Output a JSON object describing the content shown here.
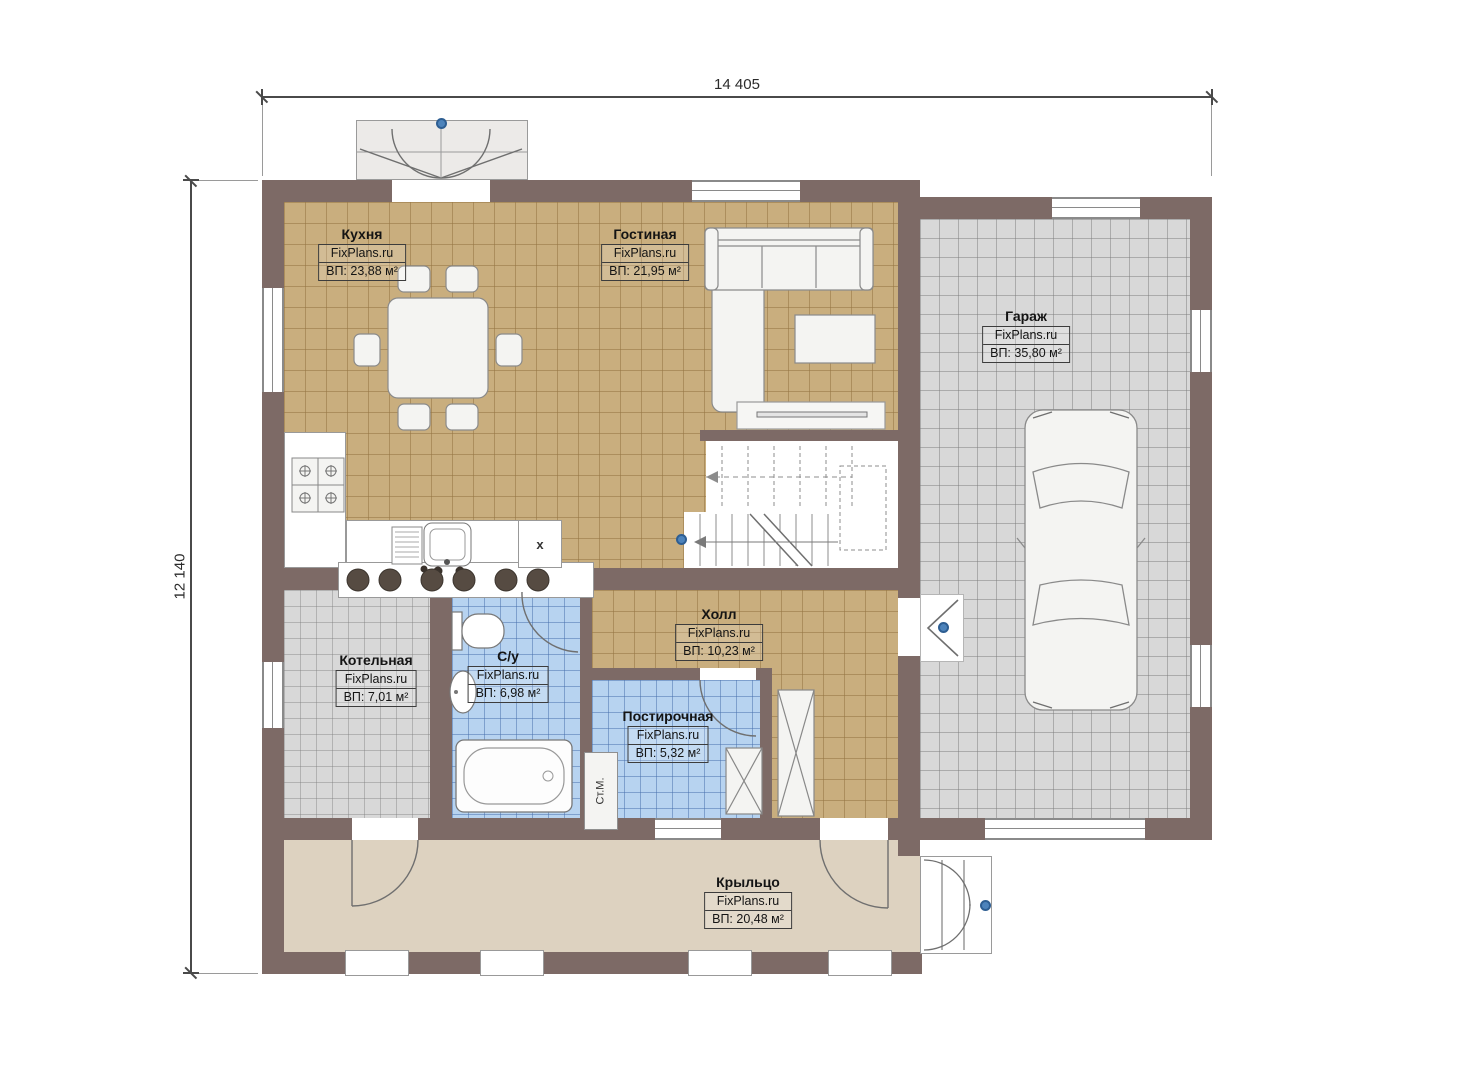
{
  "dimensions": {
    "width_label": "14 405",
    "height_label": "12 140"
  },
  "brand": "FixPlans.ru",
  "rooms": [
    {
      "id": "kitchen",
      "name": "Кухня",
      "brand": "FixPlans.ru",
      "area": "ВП: 23,88 м²"
    },
    {
      "id": "living",
      "name": "Гостиная",
      "brand": "FixPlans.ru",
      "area": "ВП: 21,95 м²"
    },
    {
      "id": "garage",
      "name": "Гараж",
      "brand": "FixPlans.ru",
      "area": "ВП: 35,80 м²"
    },
    {
      "id": "boiler",
      "name": "Котельная",
      "brand": "FixPlans.ru",
      "area": "ВП: 7,01 м²"
    },
    {
      "id": "bathroom",
      "name": "С/у",
      "brand": "FixPlans.ru",
      "area": "ВП: 6,98 м²"
    },
    {
      "id": "hall",
      "name": "Холл",
      "brand": "FixPlans.ru",
      "area": "ВП: 10,23 м²"
    },
    {
      "id": "laundry",
      "name": "Постирочная",
      "brand": "FixPlans.ru",
      "area": "ВП: 5,32 м²"
    },
    {
      "id": "porch",
      "name": "Крыльцо",
      "brand": "FixPlans.ru",
      "area": "ВП: 20,48 м²"
    }
  ],
  "annotations": {
    "washing_machine": "Ст.М.",
    "cabinet_mark": "x"
  },
  "colors": {
    "wall": "#7d6a66",
    "floor_tan": "#c9ae7e",
    "floor_gray": "#d8d8d8",
    "floor_blue": "#b7d3f0",
    "porch": "#ddd2c0",
    "marker_blue": "#4d83bb"
  }
}
